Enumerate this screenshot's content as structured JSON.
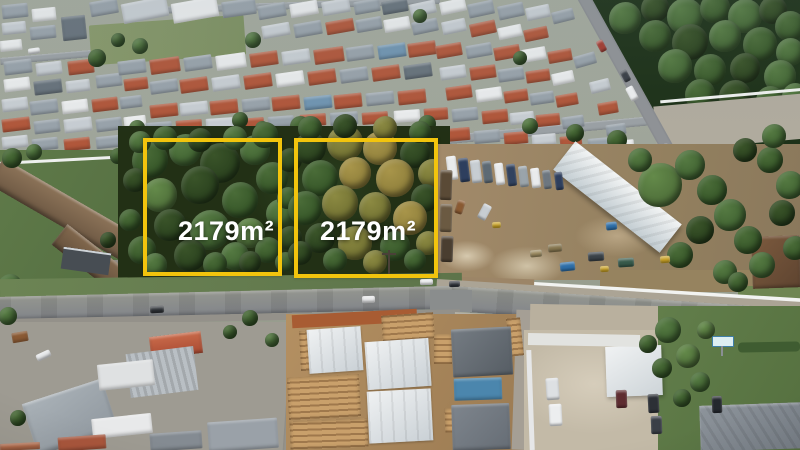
{
  "annotations": {
    "outline_color": "#F2C40D",
    "label_text_color": "#FFFFFF",
    "plots": [
      {
        "id": "plot-left",
        "area_label": "2179m²"
      },
      {
        "id": "plot-right",
        "area_label": "2179m²"
      }
    ]
  },
  "scene": {
    "type": "aerial-drone-photograph",
    "regions": {
      "residential_neighborhood": "dense houses with terracotta, grey and white roofs",
      "forest": "dark tree stand at top right",
      "plots": "two adjacent tree-covered vacant lots outlined in yellow",
      "industrial_yard": "dirt truck yard with long white warehouse and white fence",
      "main_road": "paved street in front of the plots",
      "construction_site": "new houses under construction with timber framing",
      "school_building": "large brown hip-roof building at left",
      "parking_area": "dirt lot with parked pickups and dark cars",
      "lawn": "green lawns at bottom right"
    }
  }
}
